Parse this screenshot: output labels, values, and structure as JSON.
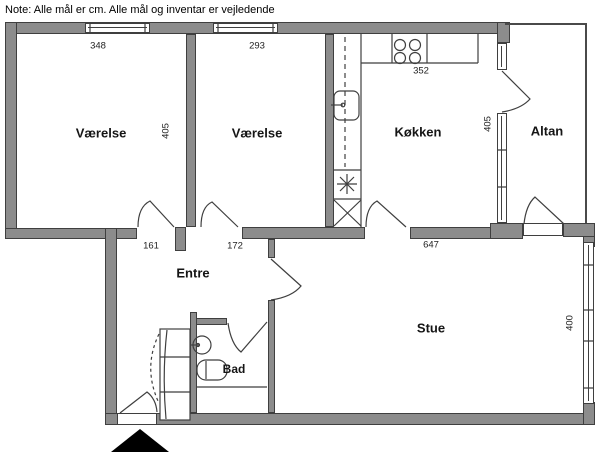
{
  "note": "Note: Alle mål er cm. Alle mål og inventar er vejledende",
  "rooms": {
    "vaerelse_left": {
      "label": "Værelse",
      "width_cm": "348",
      "depth_cm": "405"
    },
    "vaerelse_mid": {
      "label": "Værelse",
      "width_cm": "293"
    },
    "koekken": {
      "label": "Køkken",
      "width_cm": "352",
      "depth_cm": "405"
    },
    "altan": {
      "label": "Altan"
    },
    "entre": {
      "label": "Entre",
      "left_opening_cm": "161",
      "right_opening_cm": "172"
    },
    "bad": {
      "label": "Bad"
    },
    "stue": {
      "label": "Stue",
      "width_cm": "647",
      "depth_cm": "400"
    }
  },
  "colors": {
    "wall_fill": "#8c8c8c",
    "wall_line": "#3f3f3f",
    "text": "#111111"
  }
}
